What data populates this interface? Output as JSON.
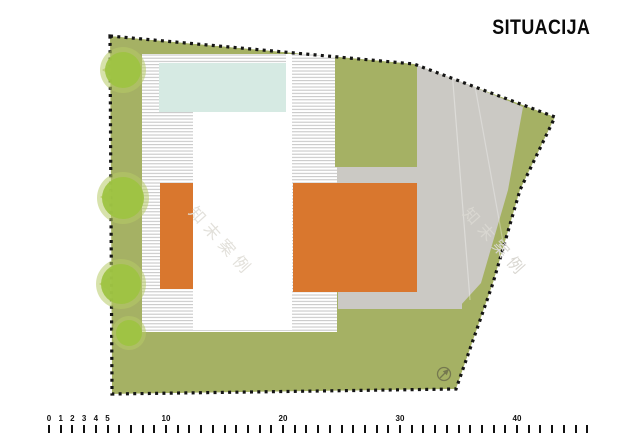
{
  "title": "SITUACIJA",
  "plan": {
    "watermark_text": "知末案例",
    "north_arrow_direction": "northeast"
  },
  "colors": {
    "olive": "#a5b164",
    "orange": "#d9772e",
    "gray": "#cbc9c4",
    "pool": "#d6eae3",
    "building_white": "#ffffff",
    "hatch_line": "#c3c3c3",
    "boundary_black": "#151515",
    "tree_core": "#9ec342",
    "tree_halo": "#b6cb66",
    "north": "#75784f",
    "watermark_gray": "#dedcd7"
  },
  "scale_bar": {
    "origin_px": 49,
    "unit_px": 11.7,
    "tick_from": 0,
    "tick_to": 46,
    "labels": [
      {
        "text": "0",
        "m": 0
      },
      {
        "text": "1",
        "m": 1
      },
      {
        "text": "2",
        "m": 2
      },
      {
        "text": "3",
        "m": 3
      },
      {
        "text": "4",
        "m": 4
      },
      {
        "text": "5",
        "m": 5
      },
      {
        "text": "10",
        "m": 10
      },
      {
        "text": "20",
        "m": 20
      },
      {
        "text": "30",
        "m": 30
      },
      {
        "text": "40",
        "m": 40
      }
    ]
  }
}
